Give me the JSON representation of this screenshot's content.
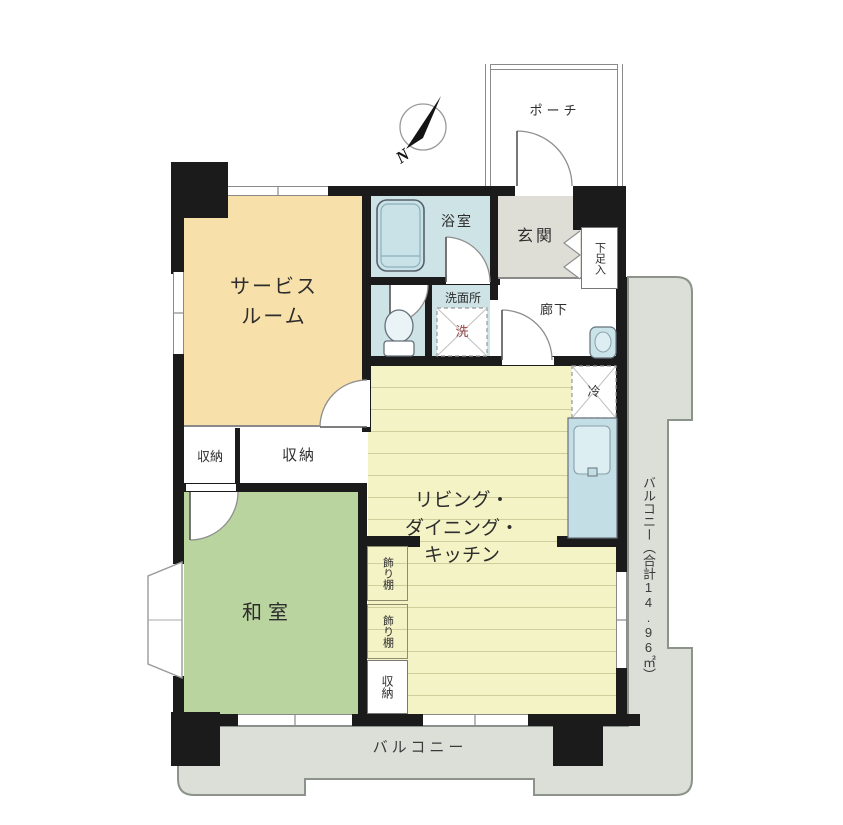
{
  "compass": {
    "north_label": "N"
  },
  "rooms": {
    "porch": "ポーチ",
    "entrance": "玄関",
    "shoe_cabinet": "下足入",
    "bathroom": "浴室",
    "washroom": "洗面所",
    "hallway": "廊下",
    "service_room_line1": "サービス",
    "service_room_line2": "ルーム",
    "ldk_line1": "リビング・",
    "ldk_line2": "ダイニング・",
    "ldk_line3": "キッチン",
    "japanese_room": "和室",
    "storage_left": "収納",
    "storage_right": "収納",
    "storage_ldk": "収納",
    "shelf_upper": "飾り棚",
    "shelf_lower": "飾り棚",
    "balcony_bottom": "バルコニー",
    "balcony_right": "バルコニー（合計14.96㎡）"
  },
  "fixtures": {
    "washing_machine": "洗",
    "refrigerator": "冷"
  },
  "colors": {
    "wall": "#1b1b1b",
    "service_room": "#F7E0A9",
    "japanese_room": "#B9D49E",
    "ldk": "#F4F3C5",
    "wet_area": "#CEE3E6",
    "entrance": "#DEDED6",
    "balcony": "#DCDFD8",
    "fixture_blue": "#C9E2E8"
  }
}
